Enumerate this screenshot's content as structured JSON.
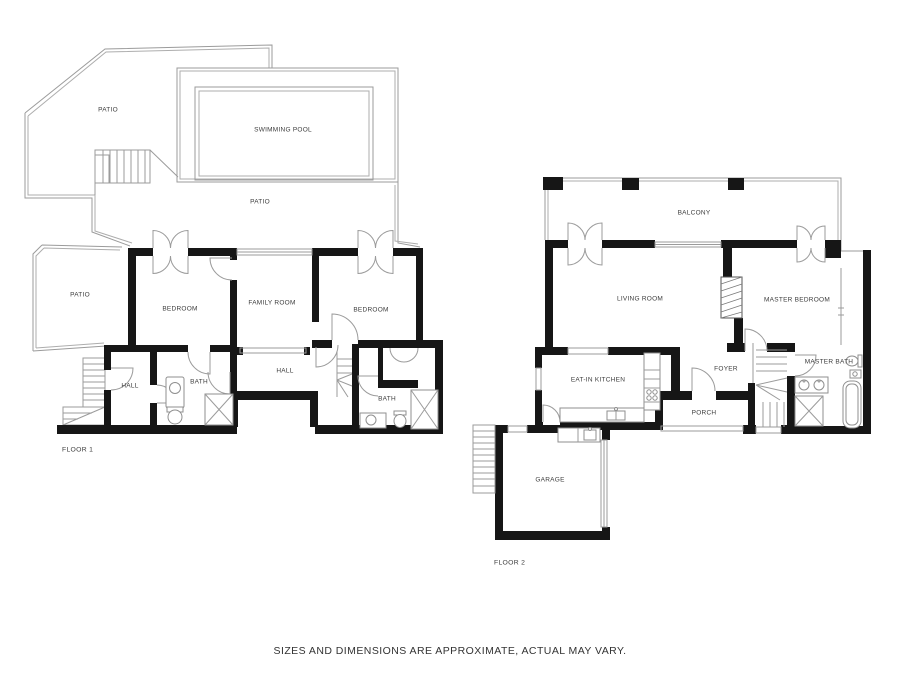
{
  "floor1": {
    "label": "FLOOR 1",
    "rooms": {
      "patio_upper": "PATIO",
      "swimming_pool": "SWIMMING POOL",
      "patio_main": "PATIO",
      "patio_side": "PATIO",
      "bedroom_left": "BEDROOM",
      "family_room": "FAMILY ROOM",
      "bedroom_right": "BEDROOM",
      "hall_small": "HALL",
      "bath_small": "BATH",
      "hall_main": "HALL",
      "bath_main": "BATH"
    }
  },
  "floor2": {
    "label": "FLOOR 2",
    "rooms": {
      "balcony": "BALCONY",
      "living_room": "LIVING ROOM",
      "master_bedroom": "MASTER BEDROOM",
      "eat_in_kitchen": "EAT-IN KITCHEN",
      "foyer": "FOYER",
      "porch": "PORCH",
      "master_bath": "MASTER BATH",
      "garage": "GARAGE"
    }
  },
  "footer": {
    "disclaimer": "SIZES AND DIMENSIONS ARE APPROXIMATE, ACTUAL MAY VARY."
  },
  "colors": {
    "wall": "#161616",
    "thin_line": "#9b9b9b",
    "label_text": "#3c3c3c",
    "background": "#ffffff"
  }
}
